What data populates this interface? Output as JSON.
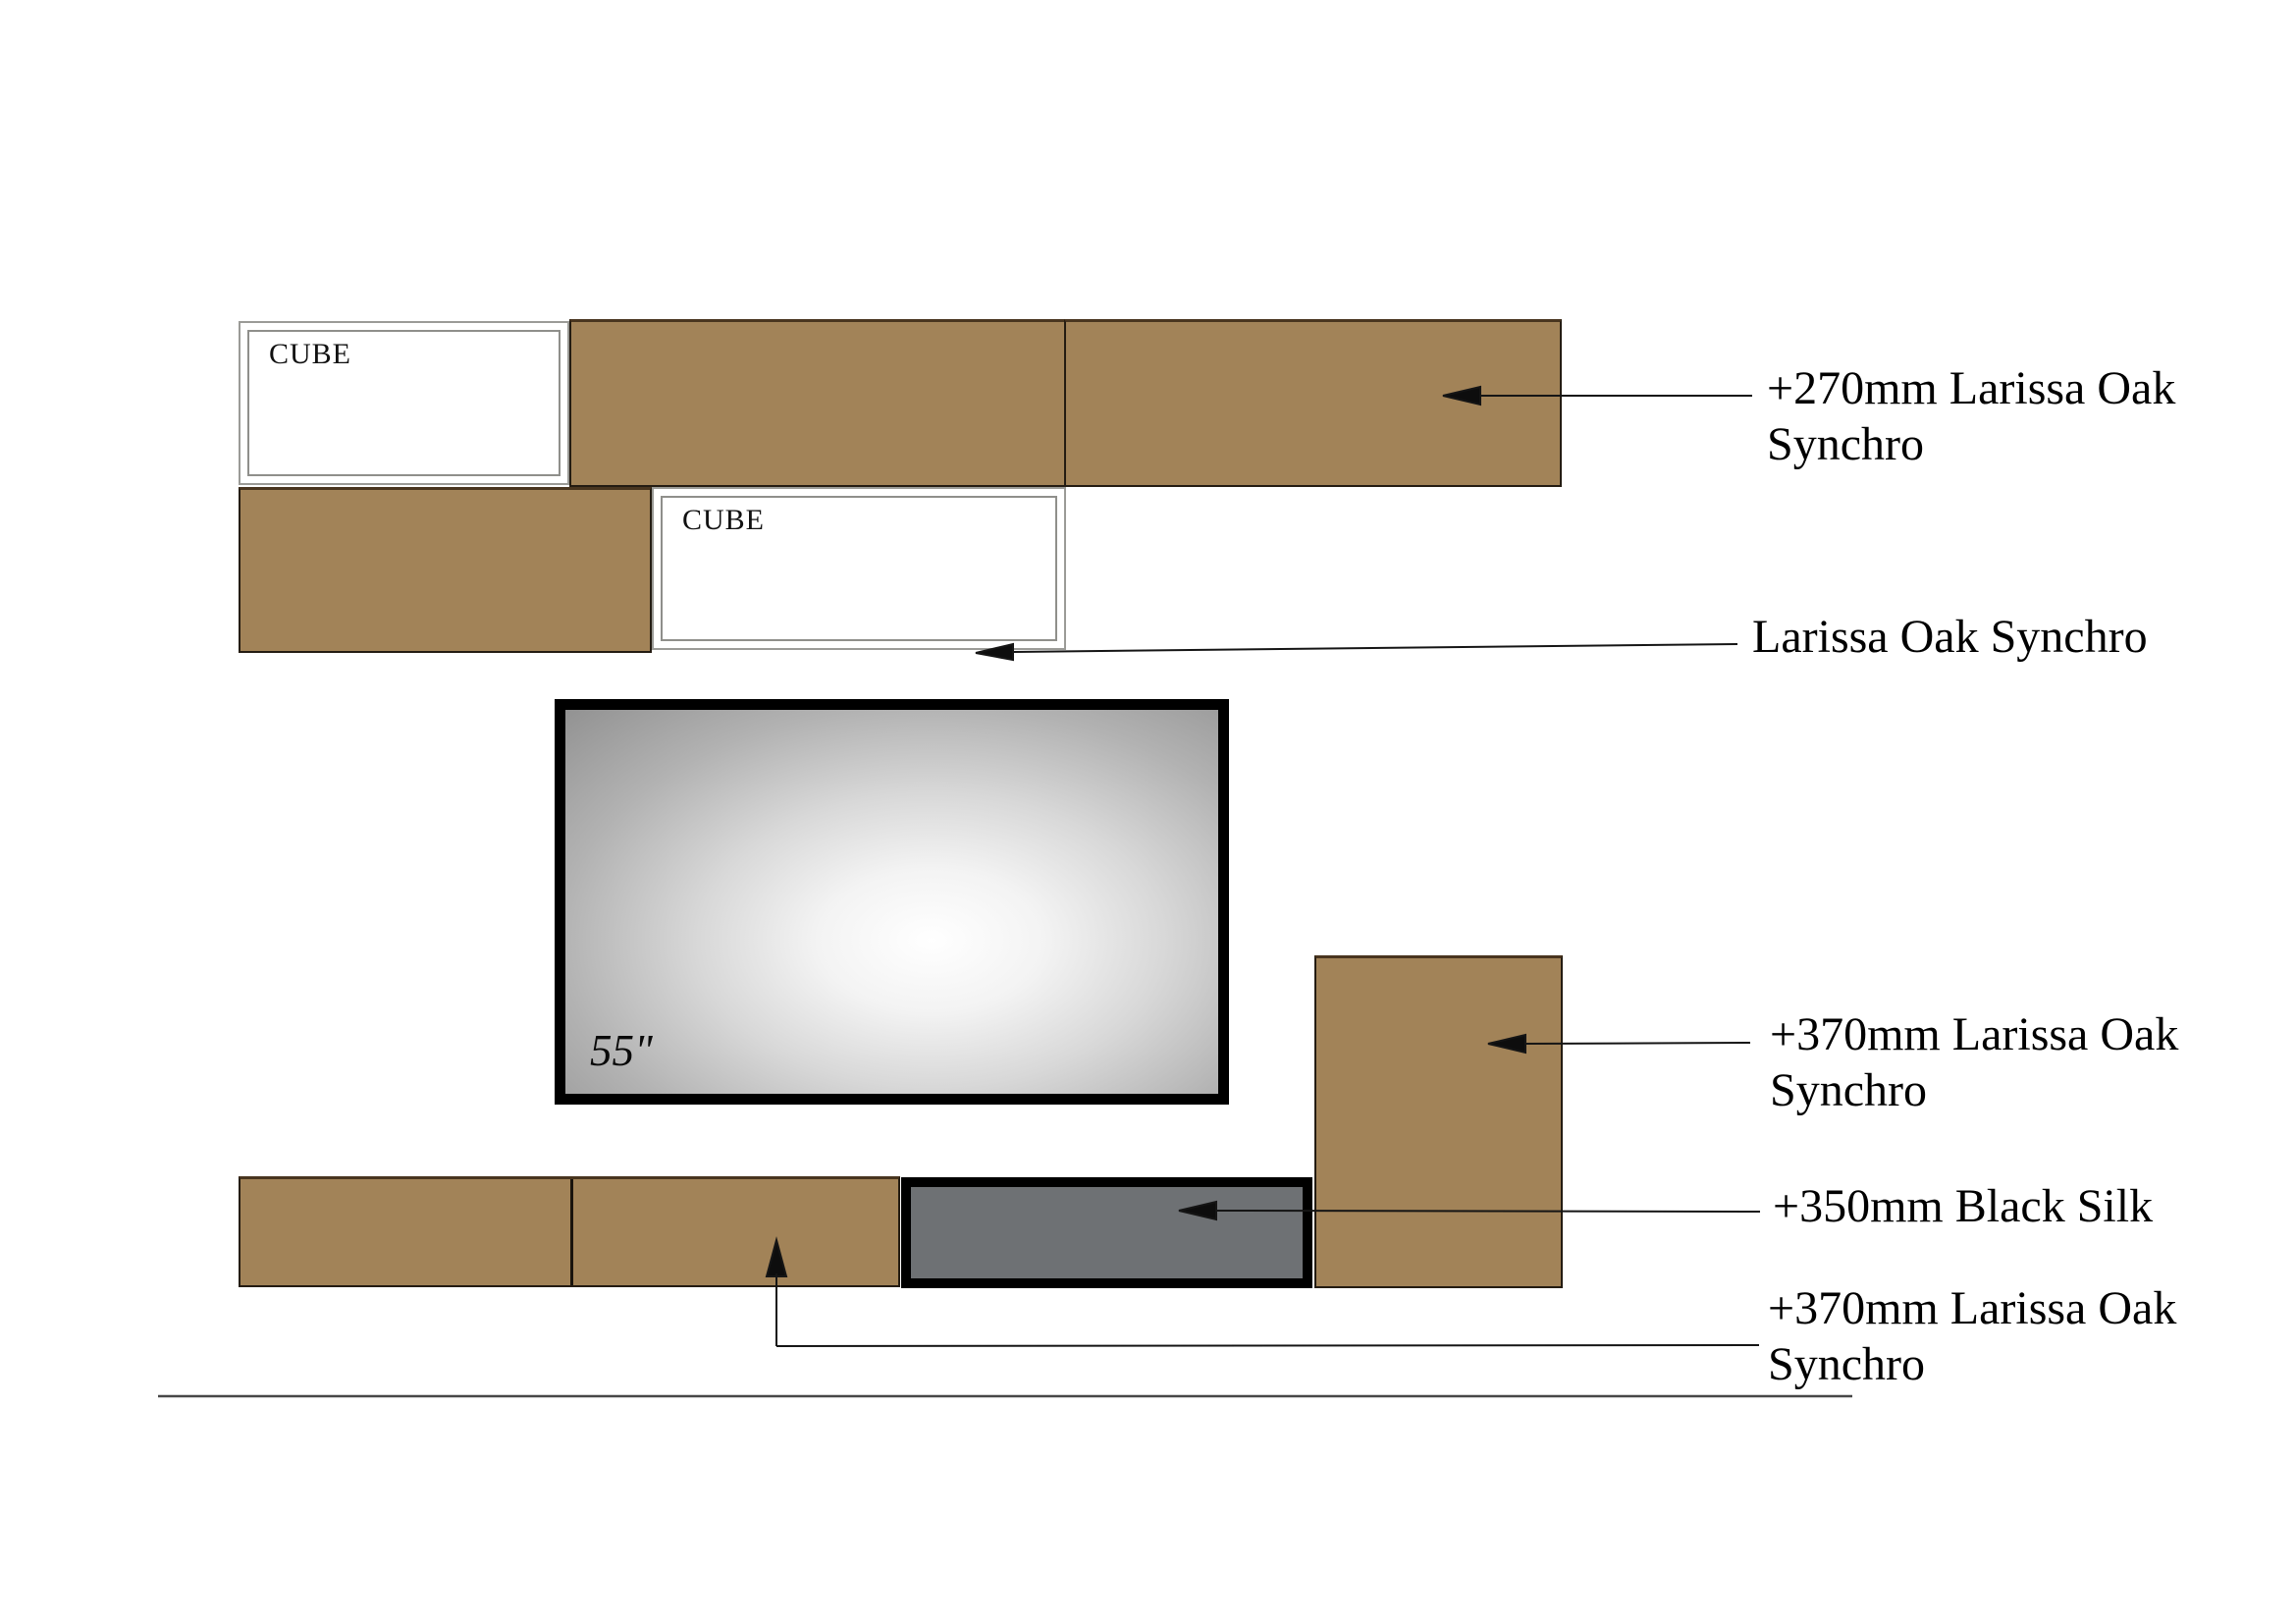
{
  "page": {
    "background": "#ffffff"
  },
  "materials": {
    "larissa_oak_color": "#a28358",
    "black_silk_color": "#6e7174",
    "tv_frame_color": "#000000"
  },
  "cubes": [
    {
      "label": "CUBE"
    },
    {
      "label": "CUBE"
    }
  ],
  "tv": {
    "size_label": "55\""
  },
  "annotations": [
    {
      "line1": "+270mm Larissa Oak",
      "line2": "Synchro"
    },
    {
      "line1": "Larissa Oak Synchro",
      "line2": ""
    },
    {
      "line1": "+370mm Larissa Oak",
      "line2": "Synchro"
    },
    {
      "line1": "+350mm Black Silk",
      "line2": ""
    },
    {
      "line1": "+370mm Larissa Oak",
      "line2": "Synchro"
    }
  ]
}
